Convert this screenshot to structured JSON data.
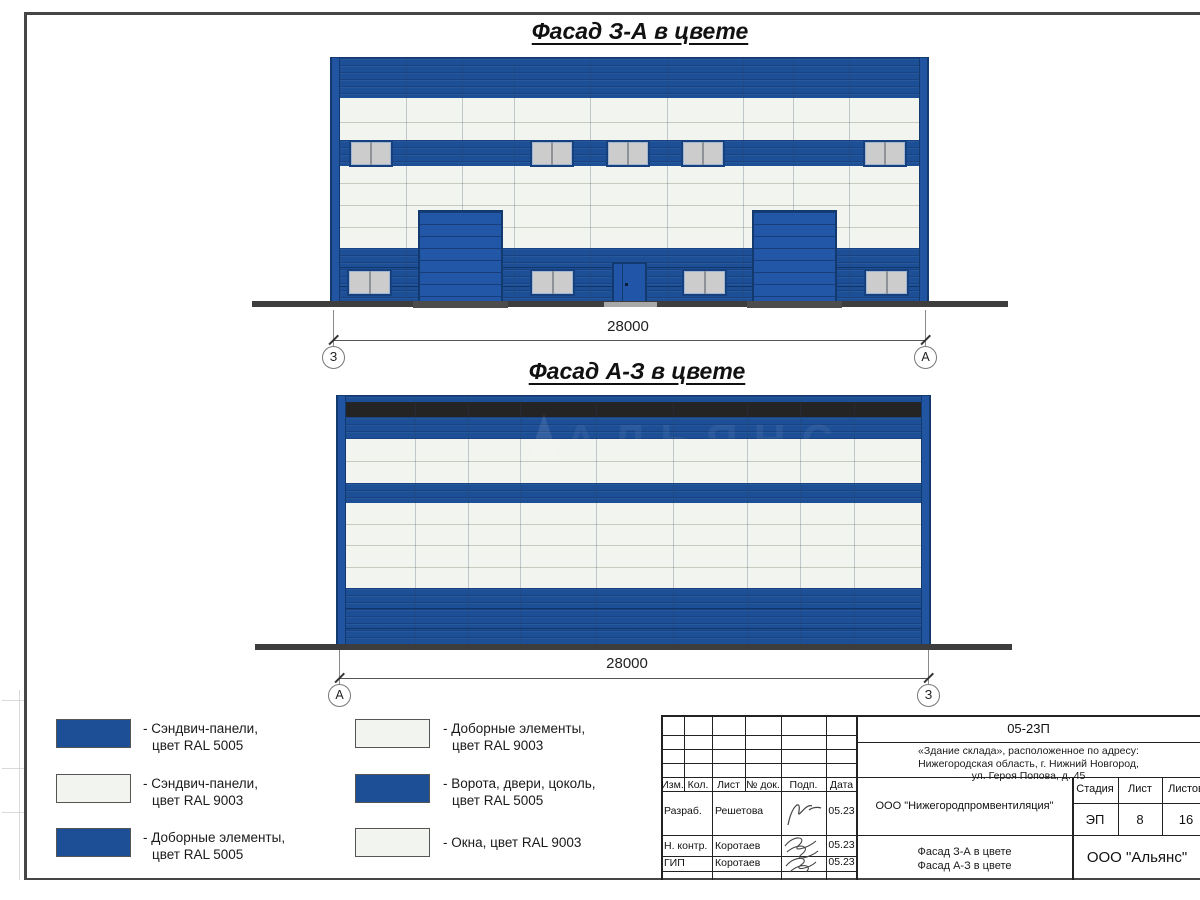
{
  "facade1": {
    "title": "Фасад З-А в цвете",
    "dimension": "28000",
    "axis_left": "З",
    "axis_right": "А"
  },
  "facade2": {
    "title": "Фасад А-З в цвете",
    "dimension": "28000",
    "axis_left": "А",
    "axis_right": "З"
  },
  "watermark": "АЛЬЯНС",
  "colors": {
    "ral5005_blue": "#1d4f97",
    "ral9003_white": "#f2f4ef",
    "gate_blue": "#2257a8",
    "parapet_black": "#242424"
  },
  "legend": {
    "items": [
      {
        "line1": "- Сэндвич-панели,",
        "line2": "цвет RAL 5005",
        "color": "#1d4f97"
      },
      {
        "line1": "- Сэндвич-панели,",
        "line2": "цвет RAL 9003",
        "color": "#f2f4ef"
      },
      {
        "line1": "- Доборные элементы,",
        "line2": "цвет RAL 5005",
        "color": "#1d4f97"
      },
      {
        "line1": "- Доборные элементы,",
        "line2": "цвет RAL 9003",
        "color": "#f2f4ef"
      },
      {
        "line1": "- Ворота, двери, цоколь,",
        "line2": "цвет RAL 5005",
        "color": "#1d4f97"
      },
      {
        "line1": "- Окна, цвет RAL 9003",
        "line2": "",
        "color": "#f2f4ef"
      }
    ]
  },
  "title_block": {
    "code": "05-23П",
    "address": [
      "«Здание склада», расположенное по адресу:",
      "Нижегородская область, г. Нижний Новгород,",
      "ул. Героя Попова, д. 45"
    ],
    "columns": [
      "Изм.",
      "Кол.",
      "Лист",
      "№ док.",
      "Подп.",
      "Дата"
    ],
    "sig_rows": [
      {
        "role": "Разраб.",
        "name": "Решетова",
        "date": "05.23"
      },
      {
        "role": "Н. контр.",
        "name": "Коротаев",
        "date": "05.23"
      },
      {
        "role": "ГИП",
        "name": "Коротаев",
        "date": "05.23"
      }
    ],
    "company": "ООО \"Нижегородпромвентиляция\"",
    "stage_columns": [
      "Стадия",
      "Лист",
      "Листов"
    ],
    "stage": "ЭП",
    "sheet_no": "8",
    "sheets_total": "16",
    "doc_title": [
      "Фасад З-А в цвете",
      "Фасад А-З в цвете"
    ],
    "org": "ООО \"Альянс\""
  }
}
